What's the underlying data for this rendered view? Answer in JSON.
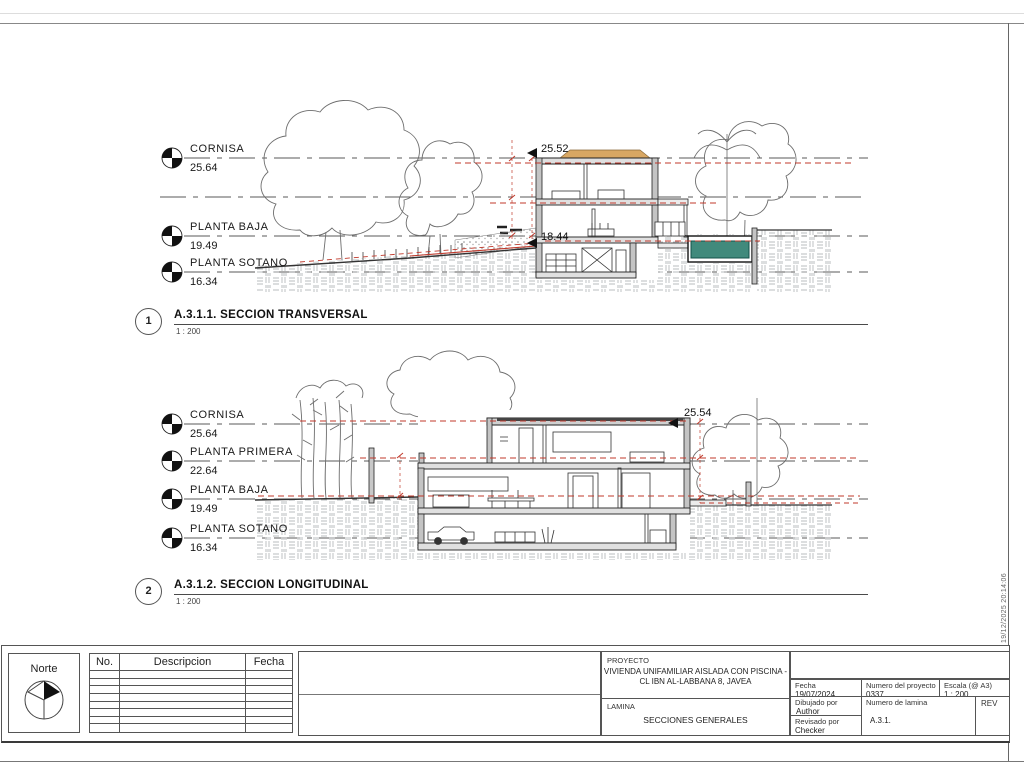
{
  "sections": [
    {
      "number": "1",
      "title": "A.3.1.1. SECCION TRANSVERSAL",
      "scale": "1 : 200",
      "levels": [
        {
          "name": "CORNISA",
          "value": "25.64"
        },
        {
          "name": "PLANTA BAJA",
          "value": "19.49"
        },
        {
          "name": "PLANTA SOTANO",
          "value": "16.34"
        }
      ],
      "spot_elevations": {
        "roof": "25.52",
        "floor": "18.44"
      }
    },
    {
      "number": "2",
      "title": "A.3.1.2. SECCION LONGITUDINAL",
      "scale": "1 : 200",
      "levels": [
        {
          "name": "CORNISA",
          "value": "25.64"
        },
        {
          "name": "PLANTA PRIMERA",
          "value": "22.64"
        },
        {
          "name": "PLANTA BAJA",
          "value": "19.49"
        },
        {
          "name": "PLANTA SOTANO",
          "value": "16.34"
        }
      ],
      "spot_elevations": {
        "roof": "25.54"
      }
    }
  ],
  "title_block": {
    "north_label": "Norte",
    "revision_table": {
      "headers": [
        "No.",
        "Descripcion",
        "Fecha"
      ]
    },
    "project_label": "PROYECTO",
    "project_name_line1": "VIVIENDA UNIFAMILIAR AISLADA CON PISCINA -",
    "project_name_line2": "CL IBN AL-LABBANA 8, JAVEA",
    "sheet_label": "LAMINA",
    "sheet_name": "SECCIONES GENERALES",
    "fields": {
      "date_label": "Fecha",
      "date": "19/07/2024",
      "project_number_label": "Numero del proyecto",
      "project_number": "0337",
      "scale_label": "Escala (@ A3)",
      "scale": "1 : 200",
      "drawn_by_label": "Dibujado por",
      "drawn_by": "Author",
      "checked_by_label": "Revisado por",
      "checked_by": "Checker",
      "sheet_number_label": "Numero de lamina",
      "sheet_number": "A.3.1.",
      "rev_label": "REV"
    }
  },
  "plot_stamp": "19/12/2025 20:14:06",
  "colors": {
    "accent_red": "#c0392b",
    "pool_water": "#40897b",
    "line": "#2b2b2b"
  }
}
